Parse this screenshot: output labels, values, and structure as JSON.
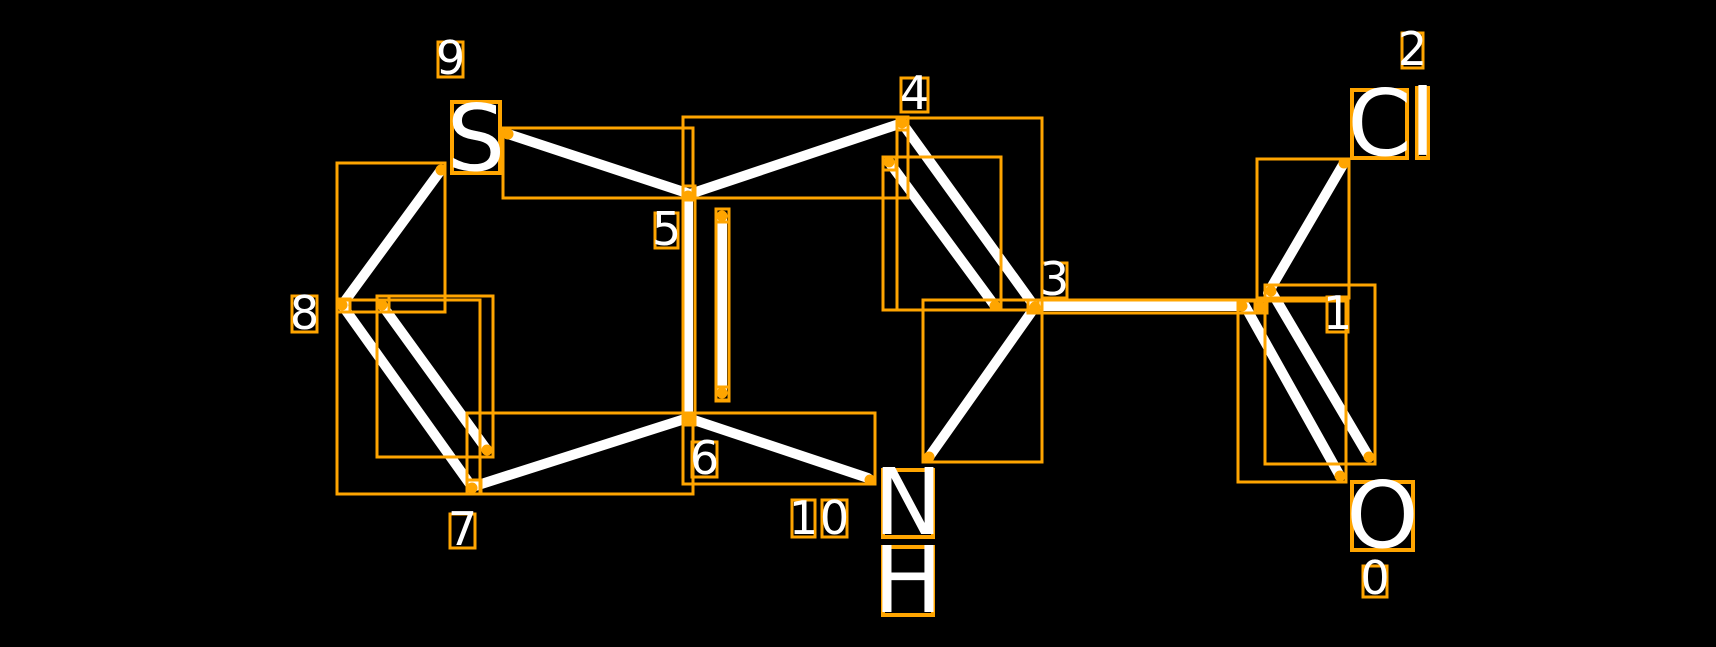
{
  "canvas": {
    "width": 1716,
    "height": 647,
    "background": "#000000"
  },
  "style": {
    "bond_color": "#ffffff",
    "bond_width": 10,
    "box_color": "#ffa500",
    "box_stroke_width": 3,
    "atom_box_stroke_width": 4,
    "dot_radius": 5.5,
    "text_color": "#ffffff",
    "atom_font_size": 92,
    "index_font_size": 46
  },
  "molecule": {
    "atom_labels": [
      {
        "name": "atom-label-S",
        "text": "S",
        "box": [
          452,
          102,
          500,
          173
        ]
      },
      {
        "name": "atom-label-N",
        "text": "N",
        "box": [
          883,
          470,
          933,
          537
        ]
      },
      {
        "name": "atom-label-H",
        "text": "H",
        "box": [
          883,
          547,
          933,
          615
        ]
      },
      {
        "name": "atom-label-C-of-Cl",
        "text": "C",
        "box": [
          1352,
          90,
          1407,
          158
        ]
      },
      {
        "name": "atom-label-l-of-Cl",
        "text": "l",
        "box": [
          1417,
          88,
          1428,
          158
        ]
      },
      {
        "name": "atom-label-O",
        "text": "O",
        "box": [
          1352,
          482,
          1413,
          550
        ]
      }
    ],
    "index_labels": [
      {
        "name": "index-label-9",
        "text": "9",
        "box": [
          438,
          42,
          463,
          77
        ]
      },
      {
        "name": "index-label-5",
        "text": "5",
        "box": [
          655,
          213,
          678,
          248
        ]
      },
      {
        "name": "index-label-4",
        "text": "4",
        "box": [
          901,
          78,
          928,
          112
        ]
      },
      {
        "name": "index-label-3",
        "text": "3",
        "box": [
          1042,
          263,
          1067,
          298
        ]
      },
      {
        "name": "index-label-8",
        "text": "8",
        "box": [
          292,
          296,
          317,
          332
        ]
      },
      {
        "name": "index-label-7",
        "text": "7",
        "box": [
          450,
          514,
          475,
          548
        ]
      },
      {
        "name": "index-label-6",
        "text": "6",
        "box": [
          692,
          442,
          717,
          477
        ]
      },
      {
        "name": "index-label-10-digit-1",
        "text": "1",
        "box": [
          792,
          500,
          815,
          537
        ]
      },
      {
        "name": "index-label-10-digit-0",
        "text": "0",
        "box": [
          822,
          500,
          847,
          537
        ]
      },
      {
        "name": "index-label-2",
        "text": "2",
        "box": [
          1402,
          33,
          1423,
          68
        ]
      },
      {
        "name": "index-label-1",
        "text": "1",
        "box": [
          1327,
          297,
          1348,
          332
        ]
      },
      {
        "name": "index-label-0",
        "text": "0",
        "box": [
          1363,
          566,
          1387,
          597
        ]
      }
    ],
    "bonds": [
      {
        "name": "bond-9-5",
        "from": [
          508,
          134
        ],
        "to": [
          690,
          194
        ]
      },
      {
        "name": "bond-5-4",
        "from": [
          690,
          194
        ],
        "to": [
          902,
          123
        ]
      },
      {
        "name": "bond-4-3",
        "from": [
          902,
          123
        ],
        "to": [
          1035,
          307
        ]
      },
      {
        "name": "bond-4-3-double-inner",
        "from": [
          889,
          162
        ],
        "to": [
          995,
          306
        ]
      },
      {
        "name": "bond-3-1",
        "from": [
          1040,
          306
        ],
        "to": [
          1245,
          306
        ]
      },
      {
        "name": "bond-1-2",
        "from": [
          1268,
          293
        ],
        "to": [
          1344,
          163
        ]
      },
      {
        "name": "bond-1-0",
        "from": [
          1245,
          306
        ],
        "to": [
          1340,
          476
        ]
      },
      {
        "name": "bond-1-0-double-inner",
        "from": [
          1271,
          291
        ],
        "to": [
          1369,
          457
        ]
      },
      {
        "name": "bond-8-9",
        "from": [
          441,
          170
        ],
        "to": [
          342,
          305
        ]
      },
      {
        "name": "bond-7-8",
        "from": [
          342,
          305
        ],
        "to": [
          472,
          487
        ]
      },
      {
        "name": "bond-7-8-double-inner",
        "from": [
          382,
          305
        ],
        "to": [
          487,
          450
        ]
      },
      {
        "name": "bond-6-7",
        "from": [
          472,
          487
        ],
        "to": [
          688,
          418
        ]
      },
      {
        "name": "bond-5-6",
        "from": [
          688,
          195
        ],
        "to": [
          688,
          418
        ]
      },
      {
        "name": "bond-5-6-double-inner",
        "from": [
          722,
          216
        ],
        "to": [
          722,
          393
        ]
      },
      {
        "name": "bond-6-10",
        "from": [
          688,
          418
        ],
        "to": [
          868,
          478
        ]
      },
      {
        "name": "bond-3-10",
        "from": [
          1035,
          307
        ],
        "to": [
          929,
          457
        ]
      }
    ],
    "bond_boxes": [
      {
        "name": "box-bond-9-5",
        "rect": [
          503,
          128,
          693,
          198
        ]
      },
      {
        "name": "box-bond-5-4",
        "rect": [
          683,
          117,
          908,
          198
        ]
      },
      {
        "name": "box-bond-4-3",
        "rect": [
          897,
          118,
          1042,
          310
        ]
      },
      {
        "name": "box-bond-4-3-inner",
        "rect": [
          883,
          157,
          1001,
          310
        ]
      },
      {
        "name": "box-bond-3-1",
        "rect": [
          1038,
          300,
          1267,
          313
        ]
      },
      {
        "name": "box-bond-1-2",
        "rect": [
          1257,
          159,
          1349,
          298
        ]
      },
      {
        "name": "box-bond-1-0",
        "rect": [
          1238,
          301,
          1346,
          482
        ]
      },
      {
        "name": "box-bond-1-0-inner",
        "rect": [
          1265,
          285,
          1375,
          464
        ]
      },
      {
        "name": "box-bond-8-9",
        "rect": [
          337,
          163,
          445,
          312
        ]
      },
      {
        "name": "box-bond-7-8",
        "rect": [
          337,
          300,
          480,
          494
        ]
      },
      {
        "name": "box-bond-7-8-inner",
        "rect": [
          377,
          296,
          493,
          457
        ]
      },
      {
        "name": "box-bond-6-7",
        "rect": [
          467,
          413,
          693,
          494
        ]
      },
      {
        "name": "box-bond-5-6",
        "rect": [
          683,
          186,
          695,
          424
        ]
      },
      {
        "name": "box-bond-5-6-inner",
        "rect": [
          716,
          209,
          729,
          400
        ]
      },
      {
        "name": "box-bond-6-10",
        "rect": [
          683,
          413,
          875,
          484
        ]
      },
      {
        "name": "box-bond-3-10",
        "rect": [
          923,
          300,
          1042,
          462
        ]
      }
    ],
    "marker_boxes": [
      {
        "name": "box-atom-4",
        "rect": [
          897,
          118,
          908,
          130
        ]
      },
      {
        "name": "box-atom-3",
        "rect": [
          1028,
          300,
          1042,
          313
        ]
      },
      {
        "name": "box-atom-5",
        "rect": [
          683,
          186,
          695,
          200
        ]
      },
      {
        "name": "box-atom-6",
        "rect": [
          683,
          413,
          695,
          425
        ]
      },
      {
        "name": "box-atom-7",
        "rect": [
          467,
          480,
          481,
          494
        ]
      },
      {
        "name": "box-atom-8",
        "rect": [
          337,
          299,
          350,
          312
        ]
      },
      {
        "name": "box-atom-1",
        "rect": [
          1255,
          300,
          1266,
          313
        ]
      },
      {
        "name": "box-inner-5-6-top",
        "rect": [
          716,
          209,
          729,
          222
        ]
      },
      {
        "name": "box-inner-5-6-bottom",
        "rect": [
          716,
          387,
          729,
          401
        ]
      },
      {
        "name": "box-inner-7-8-top",
        "rect": [
          377,
          296,
          389,
          312
        ]
      },
      {
        "name": "box-inner-4-3-top",
        "rect": [
          883,
          157,
          896,
          170
        ]
      }
    ],
    "endpoint_dots": [
      [
        508,
        134
      ],
      [
        441,
        170
      ],
      [
        342,
        305
      ],
      [
        382,
        305
      ],
      [
        472,
        488
      ],
      [
        487,
        450
      ],
      [
        688,
        196
      ],
      [
        688,
        418
      ],
      [
        722,
        216
      ],
      [
        722,
        393
      ],
      [
        902,
        123
      ],
      [
        889,
        162
      ],
      [
        995,
        306
      ],
      [
        1035,
        307
      ],
      [
        870,
        480
      ],
      [
        929,
        457
      ],
      [
        1242,
        306
      ],
      [
        1260,
        307
      ],
      [
        1271,
        291
      ],
      [
        1344,
        163
      ],
      [
        1340,
        476
      ],
      [
        1369,
        457
      ]
    ]
  }
}
